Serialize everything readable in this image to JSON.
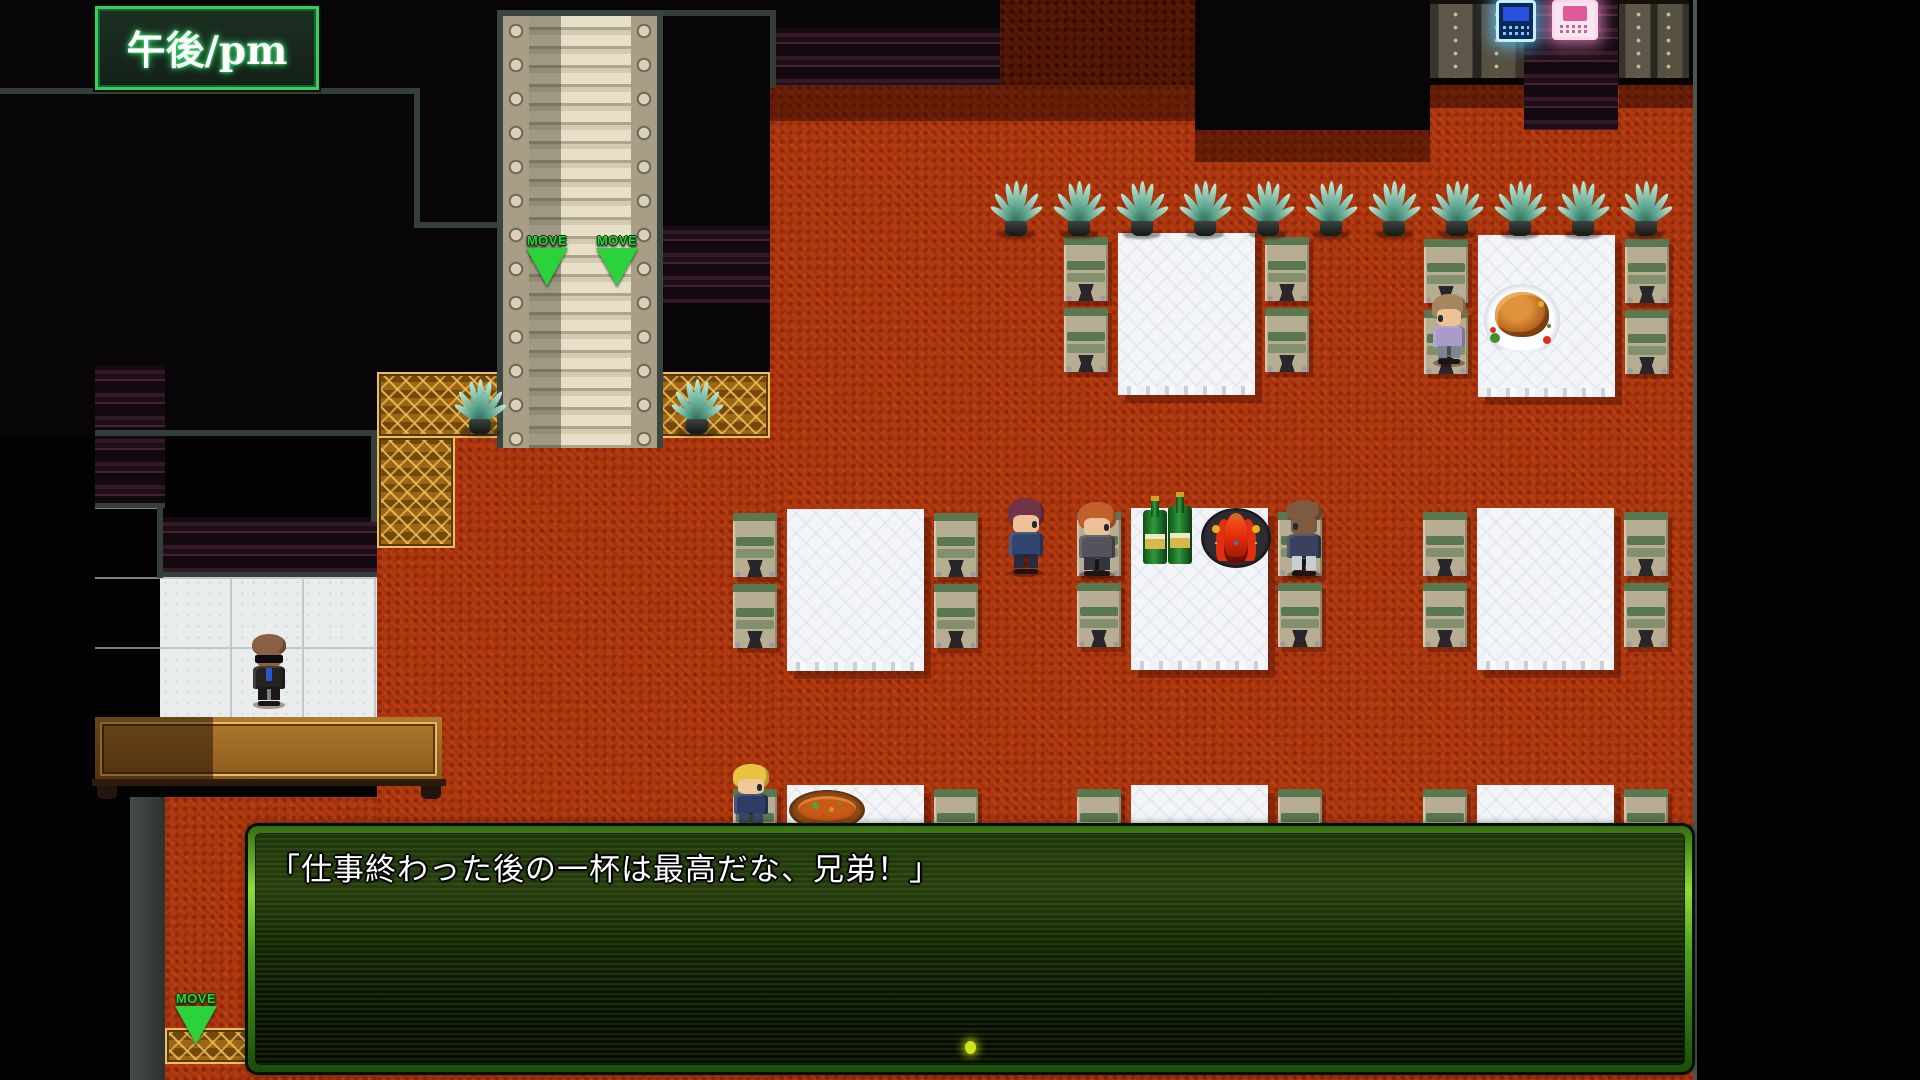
{
  "screen": {
    "width": 1920,
    "height": 1080
  },
  "hud": {
    "time_badge": {
      "label": "午後/pm"
    }
  },
  "dialog": {
    "text": "「仕事終わった後の一杯は最高だな、兄弟！」"
  },
  "colors": {
    "accent_green": "#35d14a",
    "move_green": "#2bd23a",
    "carpet_red": "#b13a0f",
    "gold_trim": "#e8c060",
    "dialog_border_green": "#8fdc36",
    "timebox_border": "#41c95e",
    "tablecloth_white": "#f3f5f8",
    "plant_teal": "#57a08a",
    "sign_blue_glow": "#5ac8ff",
    "sign_pink_glow": "#ff96d7"
  },
  "scene": {
    "rects": [
      {
        "cls": "carpet",
        "name": "carpet-floor-main",
        "x": 770,
        "y": 85,
        "w": 925,
        "h": 995
      },
      {
        "cls": "carpet",
        "name": "carpet-floor-left",
        "x": 377,
        "y": 438,
        "w": 393,
        "h": 642
      },
      {
        "cls": "carpet",
        "name": "carpet-floor-below-counter",
        "x": 165,
        "y": 797,
        "w": 212,
        "h": 283
      },
      {
        "cls": "carpet-dark",
        "name": "carpet-shadow-top",
        "x": 1000,
        "y": 0,
        "w": 195,
        "h": 85
      },
      {
        "cls": "grey-strip",
        "name": "wall-shade-strip",
        "x": 130,
        "y": 797,
        "w": 35,
        "h": 283
      },
      {
        "cls": "wall-black",
        "name": "wall-top-left",
        "x": 0,
        "y": 0,
        "w": 770,
        "h": 438
      },
      {
        "cls": "wall-black",
        "name": "wall-top-mid",
        "x": 770,
        "y": 0,
        "w": 230,
        "h": 30
      },
      {
        "cls": "wall-black",
        "name": "wall-top-right",
        "x": 1195,
        "y": 0,
        "w": 235,
        "h": 130
      },
      {
        "cls": "shadow",
        "name": "wall-shadow-band",
        "x": 770,
        "y": 85,
        "w": 425,
        "h": 36
      },
      {
        "cls": "shadow",
        "name": "wall-shadow-band",
        "x": 1195,
        "y": 130,
        "w": 235,
        "h": 32
      },
      {
        "cls": "wall-stripes",
        "name": "wall-stripes-top",
        "x": 770,
        "y": 28,
        "w": 230,
        "h": 57
      },
      {
        "cls": "wall-stripes",
        "name": "wall-stripes-left",
        "x": 95,
        "y": 365,
        "w": 70,
        "h": 143
      },
      {
        "cls": "wall-stripes",
        "name": "wall-stripes-counter",
        "x": 160,
        "y": 517,
        "w": 217,
        "h": 58
      },
      {
        "cls": "wall-stripes",
        "name": "wall-stripes-stairs-right",
        "x": 663,
        "y": 225,
        "w": 107,
        "h": 78
      },
      {
        "cls": "wall-stripes",
        "name": "wall-stripes-top-right",
        "x": 1524,
        "y": 0,
        "w": 94,
        "h": 130
      },
      {
        "cls": "shadow",
        "name": "machine-shadow",
        "x": 1430,
        "y": 78,
        "w": 94,
        "h": 30
      },
      {
        "cls": "shadow",
        "name": "machine-shadow",
        "x": 1619,
        "y": 78,
        "w": 76,
        "h": 30
      },
      {
        "cls": "gold-band",
        "name": "carpet-gold-border",
        "x": 377,
        "y": 372,
        "w": 126,
        "h": 66
      },
      {
        "cls": "gold-band",
        "name": "carpet-gold-border",
        "x": 657,
        "y": 372,
        "w": 113,
        "h": 66
      },
      {
        "cls": "gold-band",
        "name": "carpet-gold-border",
        "x": 377,
        "y": 436,
        "w": 78,
        "h": 112
      },
      {
        "cls": "gold-band",
        "name": "carpet-gold-border-bottom",
        "x": 165,
        "y": 1028,
        "w": 350,
        "h": 36
      },
      {
        "cls": "tiles-left",
        "name": "counter-tiles-shaded",
        "x": 95,
        "y": 508,
        "w": 65,
        "h": 209
      },
      {
        "cls": "tiles",
        "name": "counter-tile-top",
        "x": 160,
        "y": 577,
        "w": 217,
        "h": 140
      },
      {
        "cls": "apron",
        "name": "counter-front-panel",
        "x": 95,
        "y": 717,
        "w": 347,
        "h": 64
      },
      {
        "cls": "shadow",
        "name": "counter-front-shade",
        "x": 95,
        "y": 717,
        "w": 118,
        "h": 64
      },
      {
        "cls": "apron-ledge",
        "name": "counter-ledge",
        "x": 92,
        "y": 779,
        "w": 354,
        "h": 7
      },
      {
        "cls": "leg",
        "name": "counter-leg",
        "x": 97,
        "y": 786,
        "w": 20,
        "h": 13
      },
      {
        "cls": "leg",
        "name": "counter-leg",
        "x": 421,
        "y": 786,
        "w": 20,
        "h": 13
      },
      {
        "cls": "wall-line",
        "name": "wall-edge-line",
        "x": 0,
        "y": 88,
        "w": 420,
        "h": 6
      },
      {
        "cls": "wall-line",
        "name": "wall-edge-line",
        "x": 414,
        "y": 88,
        "w": 6,
        "h": 140
      },
      {
        "cls": "wall-line",
        "name": "wall-edge-line",
        "x": 414,
        "y": 222,
        "w": 89,
        "h": 6
      },
      {
        "cls": "wall-line",
        "name": "wall-edge-line",
        "x": 663,
        "y": 10,
        "w": 113,
        "h": 6
      },
      {
        "cls": "wall-line",
        "name": "wall-edge-line",
        "x": 770,
        "y": 10,
        "w": 6,
        "h": 78
      },
      {
        "cls": "wall-line",
        "name": "wall-edge-line",
        "x": 95,
        "y": 430,
        "w": 282,
        "h": 6
      },
      {
        "cls": "wall-line",
        "name": "wall-edge-line",
        "x": 371,
        "y": 430,
        "w": 6,
        "h": 92
      },
      {
        "cls": "wall-line",
        "name": "wall-edge-line",
        "x": 95,
        "y": 503,
        "w": 70,
        "h": 5
      },
      {
        "cls": "wall-line",
        "name": "wall-edge-line",
        "x": 157,
        "y": 508,
        "w": 6,
        "h": 70
      },
      {
        "cls": "wall-line",
        "name": "wall-edge-line",
        "x": 157,
        "y": 572,
        "w": 220,
        "h": 5
      },
      {
        "cls": "edge-line",
        "name": "viewport-edge-line",
        "x": 1693,
        "y": 0,
        "w": 4,
        "h": 1080
      }
    ],
    "tables": [
      {
        "x": 1118,
        "y": 233
      },
      {
        "x": 1478,
        "y": 235
      },
      {
        "x": 787,
        "y": 509
      },
      {
        "x": 1131,
        "y": 508
      },
      {
        "x": 1477,
        "y": 508
      },
      {
        "x": 787,
        "y": 785
      },
      {
        "x": 1131,
        "y": 785
      },
      {
        "x": 1477,
        "y": 785
      }
    ],
    "table_size": {
      "w": 137,
      "h": 155
    },
    "chairs": [
      {
        "x": 1064,
        "y": 237
      },
      {
        "x": 1064,
        "y": 308
      },
      {
        "x": 1265,
        "y": 237
      },
      {
        "x": 1265,
        "y": 308
      },
      {
        "x": 1424,
        "y": 239
      },
      {
        "x": 1424,
        "y": 310
      },
      {
        "x": 1625,
        "y": 239
      },
      {
        "x": 1625,
        "y": 310
      },
      {
        "x": 733,
        "y": 513
      },
      {
        "x": 733,
        "y": 584
      },
      {
        "x": 934,
        "y": 513
      },
      {
        "x": 934,
        "y": 584
      },
      {
        "x": 1077,
        "y": 512
      },
      {
        "x": 1077,
        "y": 583
      },
      {
        "x": 1278,
        "y": 512
      },
      {
        "x": 1278,
        "y": 583
      },
      {
        "x": 1423,
        "y": 512
      },
      {
        "x": 1423,
        "y": 583
      },
      {
        "x": 1624,
        "y": 512
      },
      {
        "x": 1624,
        "y": 583
      },
      {
        "x": 733,
        "y": 789
      },
      {
        "x": 733,
        "y": 860
      },
      {
        "x": 934,
        "y": 789
      },
      {
        "x": 934,
        "y": 860
      },
      {
        "x": 1077,
        "y": 789
      },
      {
        "x": 1077,
        "y": 860
      },
      {
        "x": 1278,
        "y": 789
      },
      {
        "x": 1278,
        "y": 860
      },
      {
        "x": 1423,
        "y": 789
      },
      {
        "x": 1423,
        "y": 860
      },
      {
        "x": 1624,
        "y": 789
      },
      {
        "x": 1624,
        "y": 860
      }
    ],
    "chair_size": {
      "w": 44,
      "h": 64
    },
    "plants": [
      {
        "x": 994,
        "y": 158,
        "w": 44,
        "h": 78
      },
      {
        "x": 1057,
        "y": 158,
        "w": 44,
        "h": 78
      },
      {
        "x": 1120,
        "y": 158,
        "w": 44,
        "h": 78
      },
      {
        "x": 1183,
        "y": 158,
        "w": 44,
        "h": 78
      },
      {
        "x": 1246,
        "y": 158,
        "w": 44,
        "h": 78
      },
      {
        "x": 1309,
        "y": 158,
        "w": 44,
        "h": 78
      },
      {
        "x": 1372,
        "y": 158,
        "w": 44,
        "h": 78
      },
      {
        "x": 1435,
        "y": 158,
        "w": 44,
        "h": 78
      },
      {
        "x": 1498,
        "y": 158,
        "w": 44,
        "h": 78
      },
      {
        "x": 1561,
        "y": 158,
        "w": 44,
        "h": 78
      },
      {
        "x": 1624,
        "y": 158,
        "w": 44,
        "h": 78
      },
      {
        "x": 456,
        "y": 368,
        "w": 48,
        "h": 66
      },
      {
        "x": 673,
        "y": 368,
        "w": 48,
        "h": 66
      }
    ],
    "foods": [
      {
        "type": "turkey",
        "name": "roast-turkey-platter",
        "x": 1484,
        "y": 284,
        "w": 76,
        "h": 66
      },
      {
        "type": "bottle",
        "name": "wine-bottle",
        "x": 1143,
        "y": 510,
        "w": 24,
        "h": 54
      },
      {
        "type": "bottle",
        "name": "wine-bottle",
        "x": 1168,
        "y": 506,
        "w": 24,
        "h": 58
      },
      {
        "type": "lobster",
        "name": "lobster-platter",
        "x": 1201,
        "y": 508,
        "w": 70,
        "h": 60
      },
      {
        "type": "stew",
        "name": "stew-pot",
        "x": 789,
        "y": 790,
        "w": 76,
        "h": 40
      }
    ],
    "npcs": [
      {
        "id": "butler",
        "x": 250,
        "y": 634,
        "w": 38,
        "h": 72,
        "bald": true,
        "skin": "#8a5f43",
        "hair": "#8a5f43",
        "shirt": "#26231f",
        "pants": "#1b1917",
        "facing": "down",
        "sunglasses": true,
        "tie": "#2f55cc"
      },
      {
        "id": "brown-hair-guest",
        "x": 1430,
        "y": 294,
        "w": 38,
        "h": 70,
        "skin": "#eec296",
        "hair": "#a5875f",
        "shirt": "#a89cc8",
        "pants": "#7a8696",
        "facing": "left"
      },
      {
        "id": "maroon-hair-guest",
        "x": 1006,
        "y": 498,
        "w": 40,
        "h": 76,
        "skin": "#eec296",
        "hair": "#703345",
        "shirt": "#31456e",
        "pants": "#262b3d",
        "facing": "right"
      },
      {
        "id": "orange-hair-guest",
        "x": 1076,
        "y": 502,
        "w": 42,
        "h": 74,
        "skin": "#eec296",
        "hair": "#c2602c",
        "shirt": "#53535b",
        "pants": "#34343c",
        "facing": "right"
      },
      {
        "id": "bald-guest",
        "x": 1284,
        "y": 500,
        "w": 40,
        "h": 76,
        "bald": true,
        "skin": "#7d5a40",
        "hair": "#7d5a40",
        "shirt": "#39415c",
        "pants": "#c9cdd6",
        "facing": "left"
      },
      {
        "id": "blond-guest",
        "x": 731,
        "y": 764,
        "w": 40,
        "h": 66,
        "skin": "#f0c89a",
        "hair": "#e7c33f",
        "shirt": "#2e3c66",
        "pants": "#3a4668",
        "facing": "right"
      }
    ],
    "move_markers": [
      {
        "label": "MOVE",
        "x": 515,
        "y": 234,
        "dim": false
      },
      {
        "label": "MOVE",
        "x": 585,
        "y": 234,
        "dim": false
      },
      {
        "label": "MOVE",
        "x": 164,
        "y": 992,
        "dim": false
      },
      {
        "label": "MOVE",
        "x": 244,
        "y": 992,
        "dim": true
      },
      {
        "label": "MOVE",
        "x": 308,
        "y": 992,
        "dim": true
      }
    ],
    "stairs": {
      "x": 497,
      "y": 10,
      "w": 166,
      "h": 438
    },
    "machines": [
      {
        "x": 1430,
        "y": 0,
        "w": 94,
        "h": 78
      },
      {
        "x": 1619,
        "y": 0,
        "w": 70,
        "h": 78
      }
    ],
    "signs": [
      {
        "kind": "blue",
        "x": 1496,
        "y": 0,
        "w": 40,
        "h": 42
      },
      {
        "kind": "pink",
        "x": 1552,
        "y": 0,
        "w": 46,
        "h": 40
      }
    ]
  }
}
